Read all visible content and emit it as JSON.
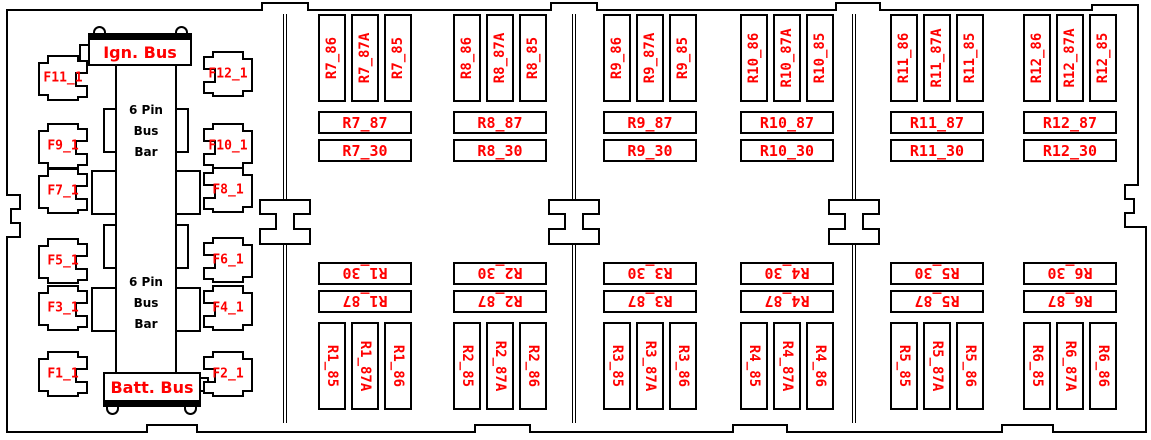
{
  "diagram": {
    "title": "fuse-relay-box-layout",
    "colors": {
      "line": "#000000",
      "label": "#ff0000",
      "background": "#ffffff"
    },
    "bus": {
      "ign_label": "Ign. Bus",
      "batt_label": "Batt. Bus"
    },
    "bus_bar_text": [
      "6 Pin",
      "Bus",
      "Bar"
    ],
    "fuses": [
      "F11_1",
      "F12_1",
      "F9_1",
      "F10_1",
      "F7_1",
      "F8_1",
      "F5_1",
      "F6_1",
      "F3_1",
      "F4_1",
      "F1_1",
      "F2_1"
    ],
    "relays_top": [
      "R7",
      "R8",
      "R9",
      "R10",
      "R11",
      "R12"
    ],
    "relays_bottom": [
      "R1",
      "R2",
      "R3",
      "R4",
      "R5",
      "R6"
    ],
    "terminals": {
      "vertical": [
        "86",
        "87A",
        "85"
      ],
      "horizontal": [
        "87",
        "30"
      ]
    },
    "label_separator": "_"
  }
}
